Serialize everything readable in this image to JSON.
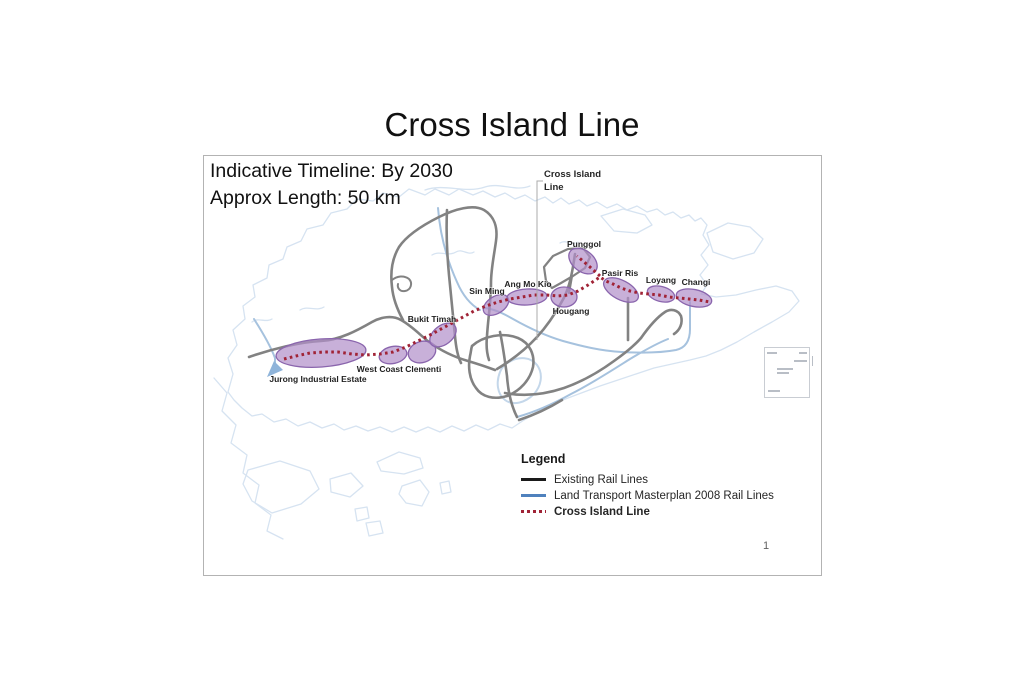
{
  "slide": {
    "title": "Cross Island Line",
    "info_lines": [
      "Indicative Timeline: By 2030",
      "Approx Length: 50 km"
    ],
    "page_number": "1"
  },
  "map": {
    "callout": {
      "label": "Cross Island Line"
    },
    "stations": [
      {
        "name": "Jurong Industrial Estate"
      },
      {
        "name": "West Coast Clementi"
      },
      {
        "name": "Bukit Timah"
      },
      {
        "name": "Sin Ming"
      },
      {
        "name": "Ang Mo Kio"
      },
      {
        "name": "Hougang"
      },
      {
        "name": "Punggol"
      },
      {
        "name": "Pasir Ris"
      },
      {
        "name": "Loyang"
      },
      {
        "name": "Changi"
      }
    ],
    "colors": {
      "station_area_fill": "#b18fc9",
      "station_area_border": "#8a65ad",
      "cross_island_line": "#a02336",
      "existing_rail": "#828282",
      "masterplan_rail": "#a6c2de",
      "coastline": "#d6e3f1"
    }
  },
  "legend": {
    "title": "Legend",
    "items": [
      {
        "label": "Existing Rail Lines",
        "color": "#1a1a1a",
        "style": "solid"
      },
      {
        "label": "Land Transport Masterplan 2008 Rail Lines",
        "color": "#4f81bd",
        "style": "solid"
      },
      {
        "label": "Cross Island Line",
        "color": "#c00000",
        "style": "dotted"
      }
    ]
  }
}
